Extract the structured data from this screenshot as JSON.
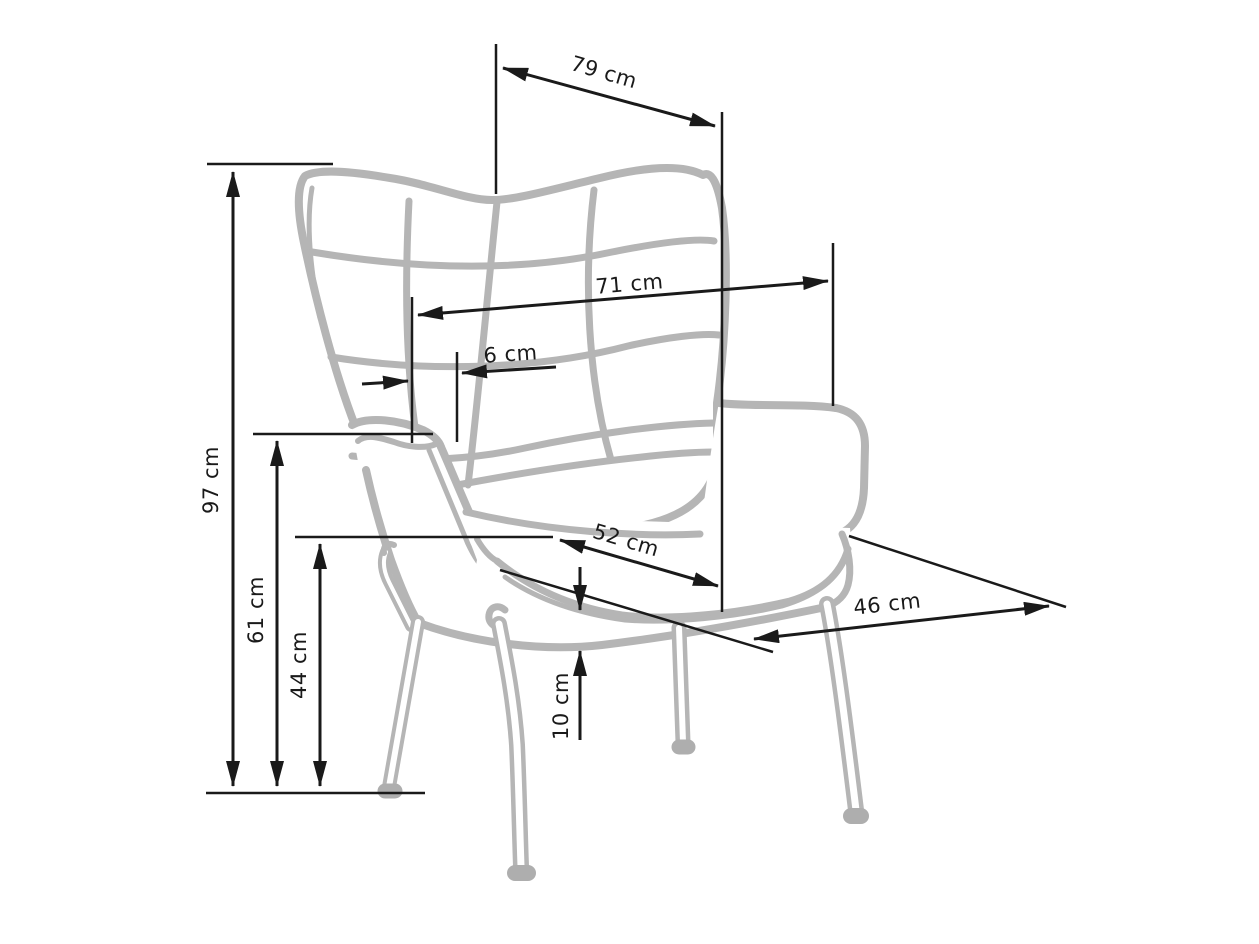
{
  "figure": {
    "kind": "furniture dimension diagram",
    "subject": "wingback tufted armchair line drawing with metal legs"
  },
  "colors": {
    "background": "#ffffff",
    "chair_line": "#b5b5b5",
    "foot_fill": "#aeaeae",
    "dimension_line": "#1a1a1a",
    "text": "#1a1a1a"
  },
  "labels": {
    "overall_depth_top": "79 cm",
    "back_width": "71 cm",
    "wing_offset": "6 cm",
    "total_height": "97 cm",
    "armrest_height": "61 cm",
    "seat_height": "44 cm",
    "seat_width": "52 cm",
    "seat_depth": "46 cm",
    "cushion_thickness": "10 cm"
  }
}
